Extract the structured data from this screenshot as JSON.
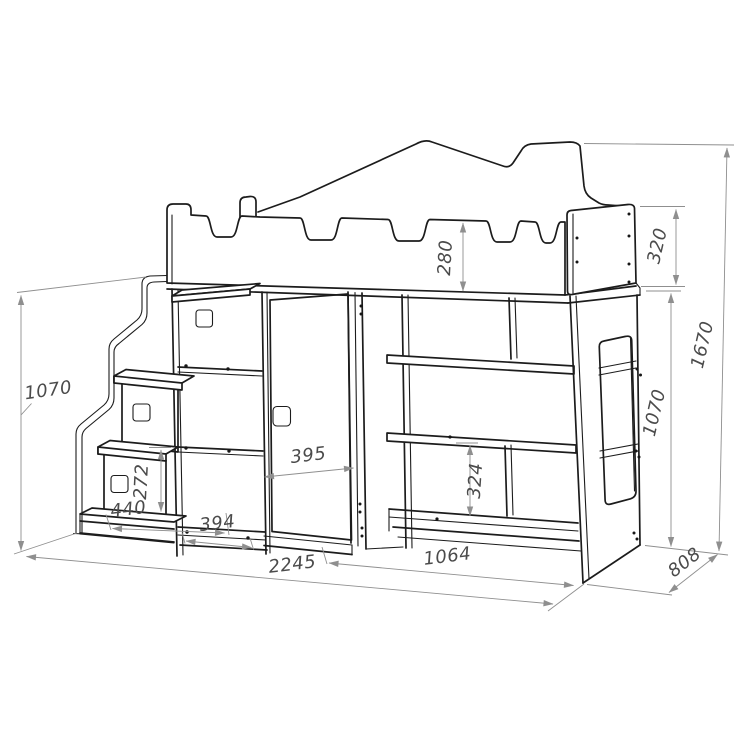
{
  "drawing": {
    "kind": "loft-bed furniture dimension drawing",
    "colors": {
      "line": "#1c1c1c",
      "dimension_line": "#8f8f8f",
      "dimension_text": "#4b4b4b",
      "background": "#ffffff"
    }
  },
  "dims": {
    "rail_height": "280",
    "end_panel_height": "320",
    "total_height": "1670",
    "ladder_height": "1070",
    "side_height": "1070",
    "door_width": "395",
    "shelf_opening_height": "324",
    "drawer_front_height": "272",
    "step_depth": "440",
    "cabinet_width": "394",
    "shelf_unit_width": "1064",
    "total_width": "2245",
    "total_depth": "808"
  }
}
